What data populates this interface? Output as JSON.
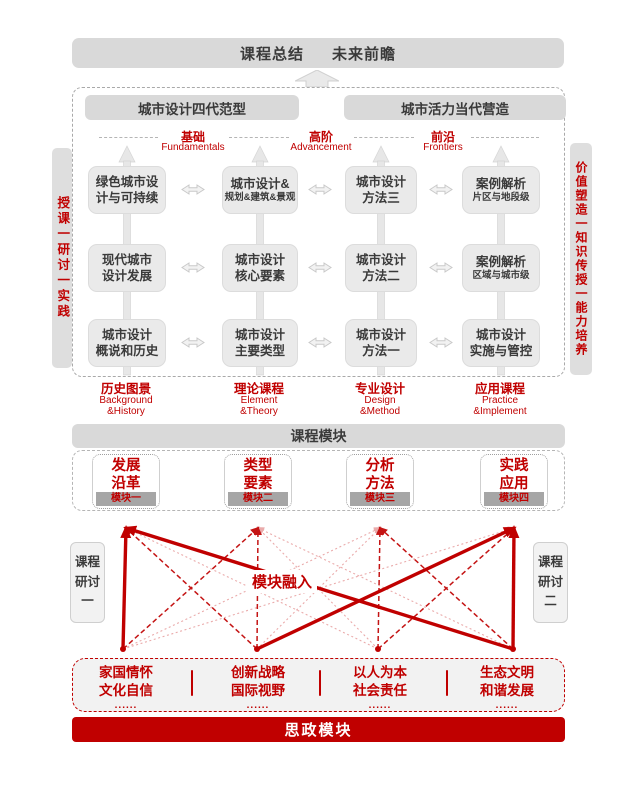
{
  "colors": {
    "red": "#c00000",
    "gray_bar": "#d9d9d9",
    "box_gray": "#eaeaea",
    "tag_gray": "#a6a6a6",
    "dark_text": "#3a3a3a",
    "dotted_red": "#eaabab",
    "dashed_red": "#c41414"
  },
  "summary_banner": {
    "left": "课程总结",
    "right": "未来前瞻"
  },
  "upper": {
    "headers": [
      "城市设计四代范型",
      "城市活力当代营造"
    ],
    "levels": [
      {
        "zh": "基础",
        "en": "Fundamentals"
      },
      {
        "zh": "高阶",
        "en": "Advancement"
      },
      {
        "zh": "前沿",
        "en": "Frontiers"
      }
    ],
    "side_left": "授课一研讨一实践",
    "side_right": "价值塑造一知识传授一能力培养",
    "grid": [
      [
        {
          "l1": "绿色城市设",
          "l2": "计与可持续"
        },
        {
          "l1": "城市设计&",
          "l2": "规划&建筑&景观"
        },
        {
          "l1": "城市设计",
          "l2": "方法三"
        },
        {
          "l1": "案例解析",
          "l2": "片区与地段级"
        }
      ],
      [
        {
          "l1": "现代城市",
          "l2": "设计发展"
        },
        {
          "l1": "城市设计",
          "l2": "核心要素"
        },
        {
          "l1": "城市设计",
          "l2": "方法二"
        },
        {
          "l1": "案例解析",
          "l2": "区域与城市级"
        }
      ],
      [
        {
          "l1": "城市设计",
          "l2": "概说和历史"
        },
        {
          "l1": "城市设计",
          "l2": "主要类型"
        },
        {
          "l1": "城市设计",
          "l2": "方法一"
        },
        {
          "l1": "城市设计",
          "l2": "实施与管控"
        }
      ]
    ],
    "footers": [
      {
        "zh": "历史图景",
        "en1": "Background",
        "en2": "&History"
      },
      {
        "zh": "理论课程",
        "en1": "Element",
        "en2": "&Theory"
      },
      {
        "zh": "专业设计",
        "en1": "Design",
        "en2": "&Method"
      },
      {
        "zh": "应用课程",
        "en1": "Practice",
        "en2": "&Implement"
      }
    ]
  },
  "module_bar_label": "课程模块",
  "modules": [
    {
      "l1": "发展",
      "l2": "沿革",
      "tag": "模块一"
    },
    {
      "l1": "类型",
      "l2": "要素",
      "tag": "模块二"
    },
    {
      "l1": "分析",
      "l2": "方法",
      "tag": "模块三"
    },
    {
      "l1": "实践",
      "l2": "应用",
      "tag": "模块四"
    }
  ],
  "seminars": {
    "left": {
      "l1": "课程",
      "l2": "研讨",
      "l3": "一"
    },
    "right": {
      "l1": "课程",
      "l2": "研讨",
      "l3": "二"
    }
  },
  "fusion_label": "模块融入",
  "web": {
    "top_x": [
      66,
      198,
      320,
      454
    ],
    "bottom_x": [
      63,
      197,
      318,
      453
    ],
    "top_y": 16,
    "bottom_y": 137,
    "edges": [
      {
        "from": 0,
        "to": 2,
        "style": "dotted"
      },
      {
        "from": 0,
        "to": 3,
        "style": "dotted"
      },
      {
        "from": 1,
        "to": 2,
        "style": "dotted"
      },
      {
        "from": 2,
        "to": 0,
        "style": "dotted"
      },
      {
        "from": 2,
        "to": 1,
        "style": "dotted"
      },
      {
        "from": 3,
        "to": 1,
        "style": "dotted"
      },
      {
        "from": 1,
        "to": 1,
        "style": "dashed"
      },
      {
        "from": 2,
        "to": 2,
        "style": "dashed"
      },
      {
        "from": 1,
        "to": 0,
        "style": "dashed"
      },
      {
        "from": 2,
        "to": 3,
        "style": "dashed"
      },
      {
        "from": 0,
        "to": 1,
        "style": "dashed"
      },
      {
        "from": 3,
        "to": 2,
        "style": "dashed"
      },
      {
        "from": 0,
        "to": 0,
        "style": "thick"
      },
      {
        "from": 3,
        "to": 0,
        "style": "thick"
      },
      {
        "from": 1,
        "to": 3,
        "style": "thick"
      },
      {
        "from": 3,
        "to": 3,
        "style": "thick"
      }
    ]
  },
  "themes": [
    {
      "l1": "家国情怀",
      "l2": "文化自信",
      "dots": "......"
    },
    {
      "l1": "创新战略",
      "l2": "国际视野",
      "dots": "......"
    },
    {
      "l1": "以人为本",
      "l2": "社会责任",
      "dots": "......"
    },
    {
      "l1": "生态文明",
      "l2": "和谐发展",
      "dots": "......"
    }
  ],
  "ideology_bar_label": "思政模块"
}
